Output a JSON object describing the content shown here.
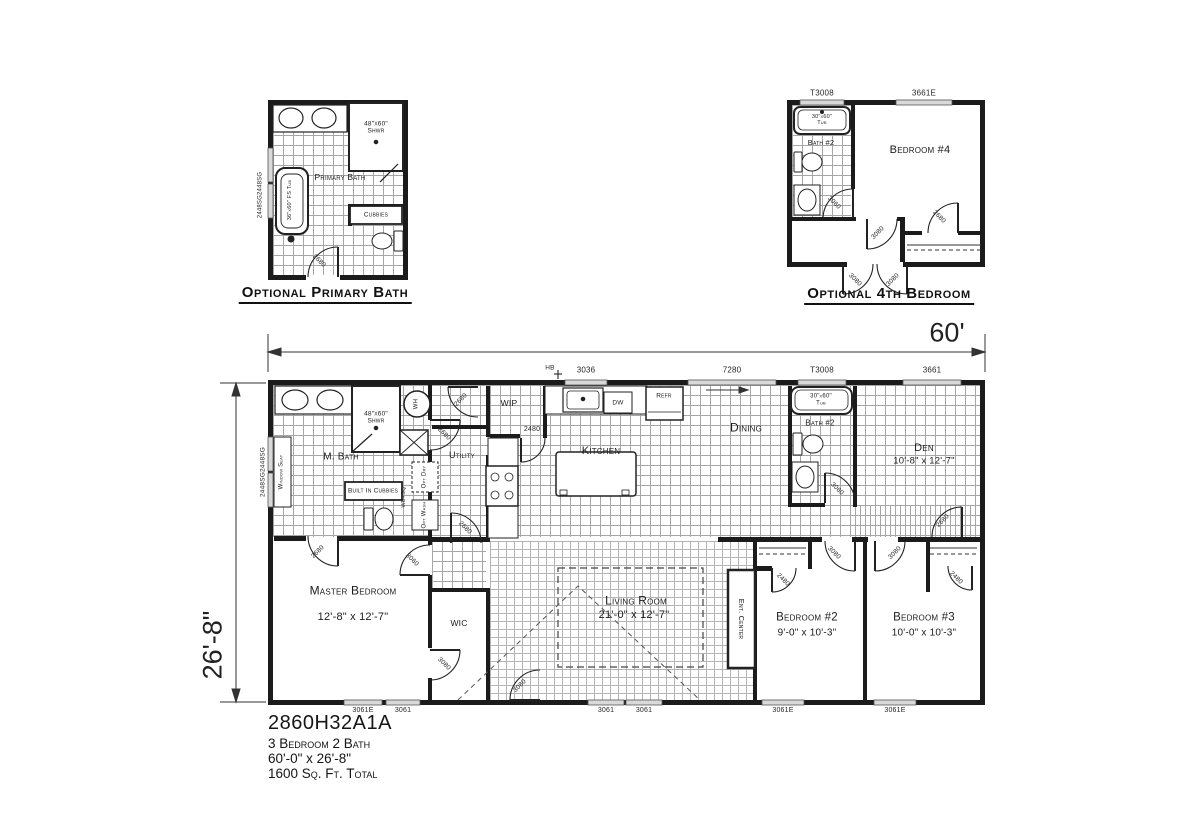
{
  "palette": {
    "wall": "#1b1b1b",
    "grid": "#a6a6a6",
    "window_fill": "#d9d9d9",
    "bg": "#ffffff",
    "text": "#1c1c1c"
  },
  "title_block": {
    "model": "2860H32A1A",
    "line1": "3 Bedroom 2 Bath",
    "line2": "60'-0\" x 26'-8\"",
    "line3": "1600 Sq. Ft. Total"
  },
  "main": {
    "dim_width": "60'",
    "dim_height": "26'-8\"",
    "windows": {
      "hb": "HB",
      "w3036": "3036",
      "w7280": "7280",
      "t3008": "T3008",
      "w3661": "3661",
      "left": "2448SG2448SG",
      "b1": "3061E",
      "b2": "3061",
      "b3": "3061",
      "b4": "3061",
      "b5": "3061E",
      "b6": "3061E"
    },
    "rooms": {
      "m_bath": "M. Bath",
      "shower": "48\"x60\"\nShwr",
      "window_seat": "Window Seat",
      "cubbies": "Built In Cubbies",
      "utility": "Utility",
      "wip": "WIP",
      "kitchen": "Kitchen",
      "dining": "Dining",
      "bath2": "Bath #2",
      "tub": "30\"x60\"\nTub",
      "den": "Den",
      "den_dims": "10'-8\" x 12'-7\"",
      "master": "Master Bedroom",
      "master_dims": "12'-8\" x 12'-7\"",
      "wic": "WIC",
      "living": "Living Room",
      "living_dims": "21'-0\" x 12'-7\"",
      "ent_center": "Ent. Center",
      "bed2": "Bedroom #2",
      "bed2_dims": "9'-0\" x 10'-3\"",
      "bed3": "Bedroom #3",
      "bed3_dims": "10'-0\" x 10'-3\""
    },
    "appliances": {
      "wh": "WH",
      "dw": "DW",
      "refr": "Refr",
      "opt_dry": "Opt Dry",
      "opt_wash": "Opt Wash",
      "wb_sq": "WB+SQ"
    },
    "doors": {
      "m_bath": "2680",
      "wh_closet": "2680",
      "hall": "2680",
      "utility": "2680",
      "wip": "2480",
      "master": "3060",
      "wic": "3080",
      "entry": "3080",
      "bath2": "3060",
      "den": "2680",
      "bed2": "3080",
      "bed3": "3080",
      "bed2_closet": "2480",
      "bed3_closet": "2480"
    }
  },
  "primary_bath_detail": {
    "caption": "Optional Primary Bath",
    "room_label": "Primary Bath",
    "shower_label": "48\"x60\"\nShwr",
    "tub_label": "36\"x60\" FS Tub",
    "cubbies_label": "Cubbies",
    "window_label": "2448SG2448SG",
    "door_label": "2680"
  },
  "fourth_bedroom_detail": {
    "caption": "Optional 4th Bedroom",
    "room_label": "Bedroom #4",
    "bath_label": "Bath #2",
    "tub_label": "30\"x60\"\nTub",
    "window_t3008": "T3008",
    "window_3661e": "3661E",
    "door_bath": "3060",
    "door_bed4": "3080",
    "door_closet": "2680",
    "door_entry_left": "3080",
    "door_entry_right": "3080"
  }
}
